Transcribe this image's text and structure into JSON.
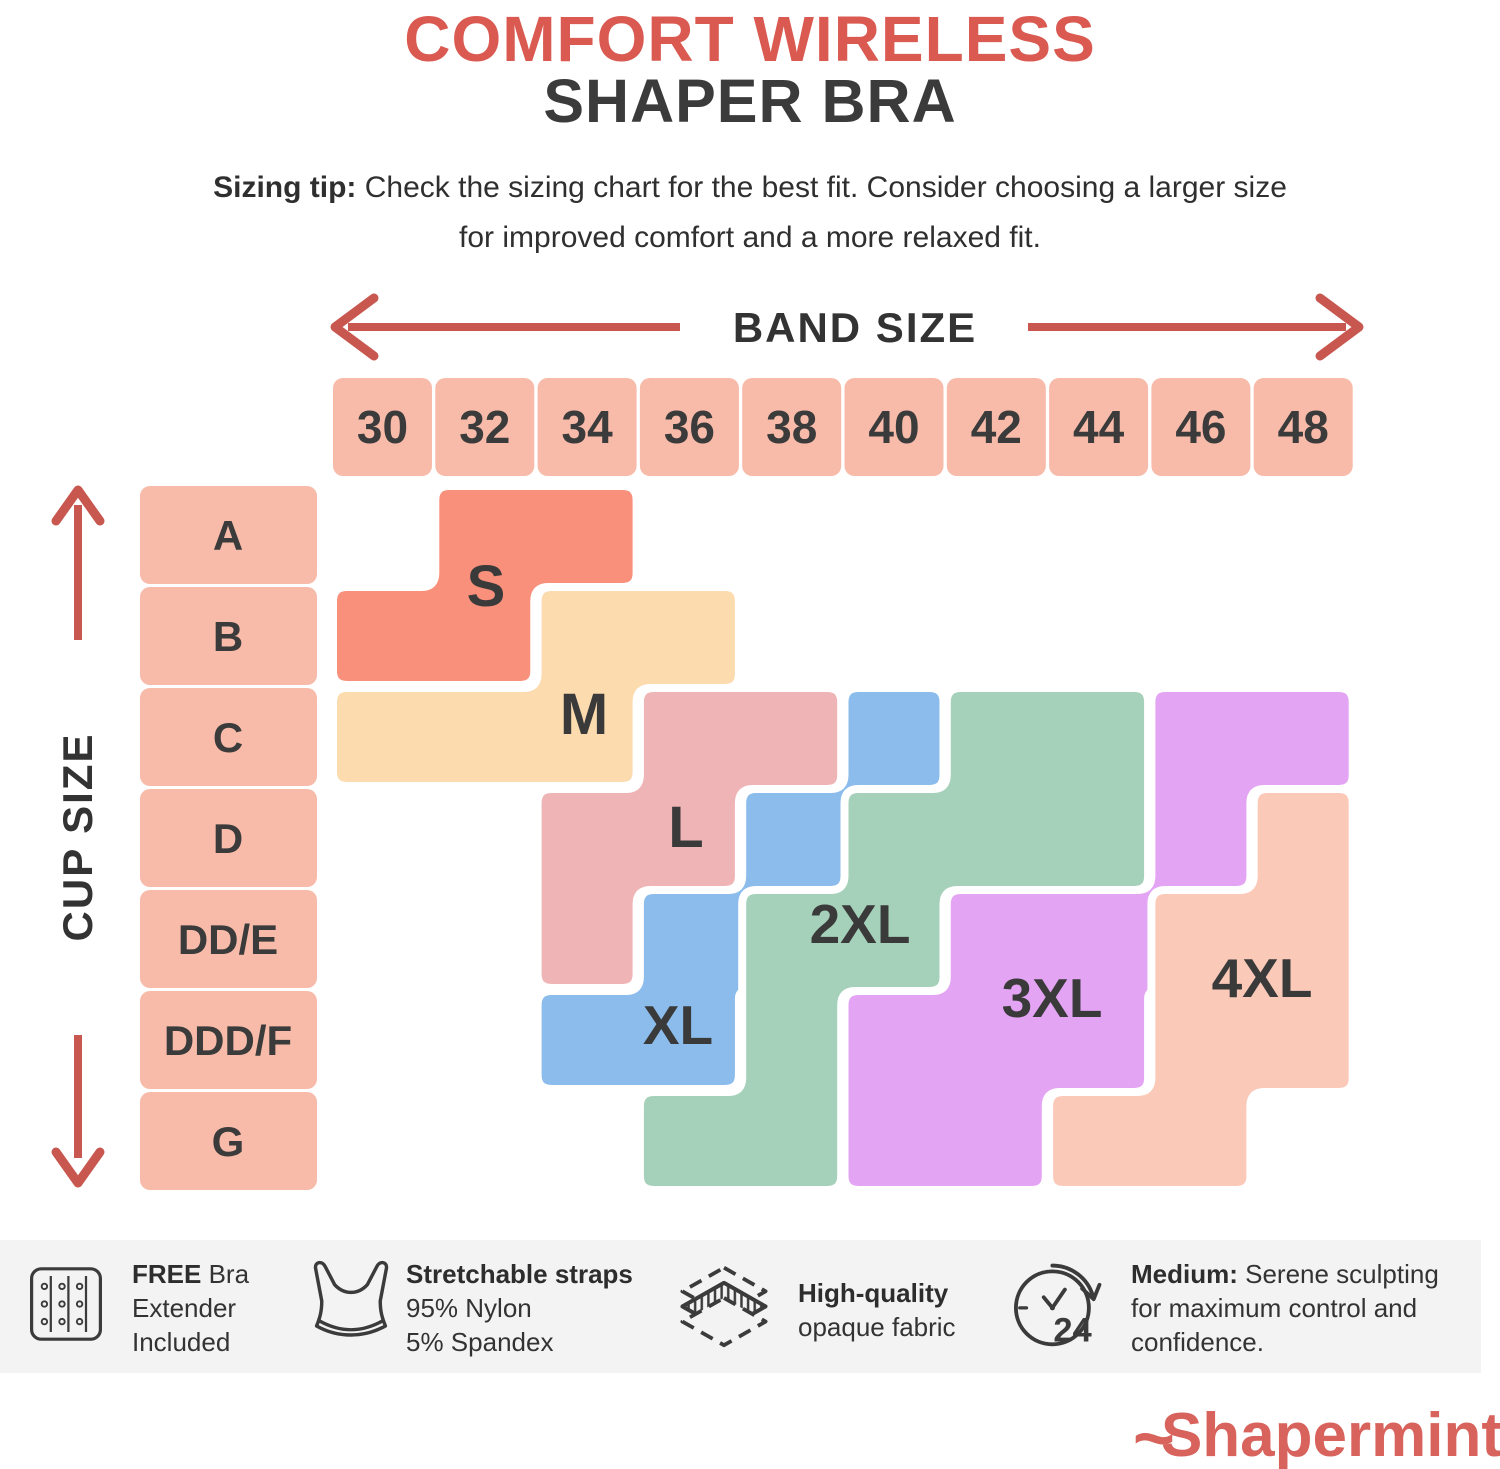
{
  "title": {
    "line1": "COMFORT WIRELESS",
    "line2": "SHAPER BRA"
  },
  "sizing_tip": {
    "bold": "Sizing tip:",
    "line1_rest": " Check the sizing chart for the best fit. Consider choosing a larger size",
    "line2": "for improved comfort and a more relaxed fit."
  },
  "axes": {
    "band_label": "BAND SIZE",
    "cup_label": "CUP SIZE"
  },
  "chart_data": {
    "type": "heatmap",
    "title": "Comfort Wireless Shaper Bra size chart",
    "xlabel": "BAND SIZE",
    "ylabel": "CUP SIZE",
    "x_categories": [
      "30",
      "32",
      "34",
      "36",
      "38",
      "40",
      "42",
      "44",
      "46",
      "48"
    ],
    "y_categories": [
      "A",
      "B",
      "C",
      "D",
      "DD/E",
      "DDD/F",
      "G"
    ],
    "legend_position": "labels-in-plot",
    "sizes": [
      {
        "name": "S",
        "color": "#F9907B",
        "label_pos": {
          "x": 486,
          "y": 586
        },
        "cells": {
          "A": [
            "32",
            "34"
          ],
          "B": [
            "30",
            "32"
          ]
        }
      },
      {
        "name": "M",
        "color": "#FCDBAF",
        "label_pos": {
          "x": 584,
          "y": 714
        },
        "cells": {
          "B": [
            "34",
            "36"
          ],
          "C": [
            "30",
            "32",
            "34"
          ]
        }
      },
      {
        "name": "L",
        "color": "#EFB4B6",
        "label_pos": {
          "x": 686,
          "y": 827
        },
        "cells": {
          "C": [
            "36",
            "38"
          ],
          "D": [
            "34",
            "36"
          ],
          "DD/E": [
            "34"
          ]
        }
      },
      {
        "name": "XL",
        "color": "#8BBCEC",
        "label_pos": {
          "x": 678,
          "y": 1024
        },
        "cells": {
          "C": [
            "40"
          ],
          "D": [
            "38"
          ],
          "DD/E": [
            "36"
          ],
          "DDD/F": [
            "34",
            "36"
          ]
        }
      },
      {
        "name": "2XL",
        "color": "#A5D0BA",
        "label_pos": {
          "x": 860,
          "y": 923
        },
        "cells": {
          "C": [
            "42",
            "44"
          ],
          "D": [
            "40",
            "42",
            "44"
          ],
          "DD/E": [
            "38",
            "40"
          ],
          "DDD/F": [
            "38"
          ],
          "G": [
            "36",
            "38"
          ]
        }
      },
      {
        "name": "3XL",
        "color": "#E4A4F4",
        "label_pos": {
          "x": 1052,
          "y": 997
        },
        "cells": {
          "C": [
            "46",
            "48"
          ],
          "D": [
            "46"
          ],
          "DD/E": [
            "42",
            "44"
          ],
          "DDD/F": [
            "40",
            "42",
            "44"
          ],
          "G": [
            "40",
            "42"
          ]
        }
      },
      {
        "name": "4XL",
        "color": "#FBC9B8",
        "label_pos": {
          "x": 1262,
          "y": 977
        },
        "cells": {
          "D": [
            "48"
          ],
          "DD/E": [
            "46",
            "48"
          ],
          "DDD/F": [
            "46",
            "48"
          ],
          "G": [
            "44",
            "46"
          ]
        }
      }
    ]
  },
  "features": [
    {
      "icon": "bra-extender-icon",
      "lines": [
        {
          "b": "FREE",
          "t": " Bra"
        },
        {
          "t": "Extender"
        },
        {
          "t": "Included"
        }
      ]
    },
    {
      "icon": "bra-icon",
      "lines": [
        {
          "b": "Stretchable straps"
        },
        {
          "t": "95% Nylon"
        },
        {
          "t": "5% Spandex"
        }
      ]
    },
    {
      "icon": "fabric-layers-icon",
      "lines": [
        {
          "b": "High-quality"
        },
        {
          "t": "opaque fabric"
        }
      ]
    },
    {
      "icon": "clock-24-icon",
      "lines": [
        {
          "b": "Medium:",
          "t": " Serene sculpting"
        },
        {
          "t": "for maximum control and"
        },
        {
          "t": "confidence."
        }
      ]
    }
  ],
  "logo": {
    "text": "Shapermint"
  },
  "colors": {
    "accent_red": "#DA5A52",
    "arrow_red": "#C8584F",
    "text_dark": "#3b3b3b",
    "header_cell": "#F8BBA9",
    "bar_bg": "#F3F3F3",
    "region_outline": "#FFFFFF",
    "logo": "#D8625C"
  }
}
